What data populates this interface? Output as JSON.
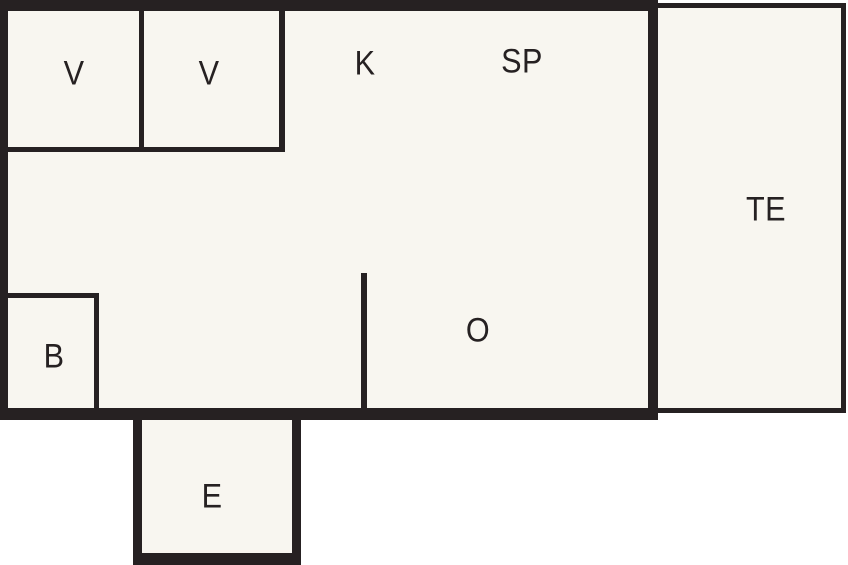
{
  "diagram": {
    "type": "floor-plan"
  },
  "colors": {
    "wall": "#262122",
    "interior": "#f8f6f0",
    "background": "#ffffff"
  },
  "rooms": {
    "v1": {
      "label": "V"
    },
    "v2": {
      "label": "V"
    },
    "k": {
      "label": "K"
    },
    "sp": {
      "label": "SP"
    },
    "te": {
      "label": "TE"
    },
    "b": {
      "label": "B"
    },
    "o": {
      "label": "O"
    },
    "e": {
      "label": "E"
    }
  }
}
